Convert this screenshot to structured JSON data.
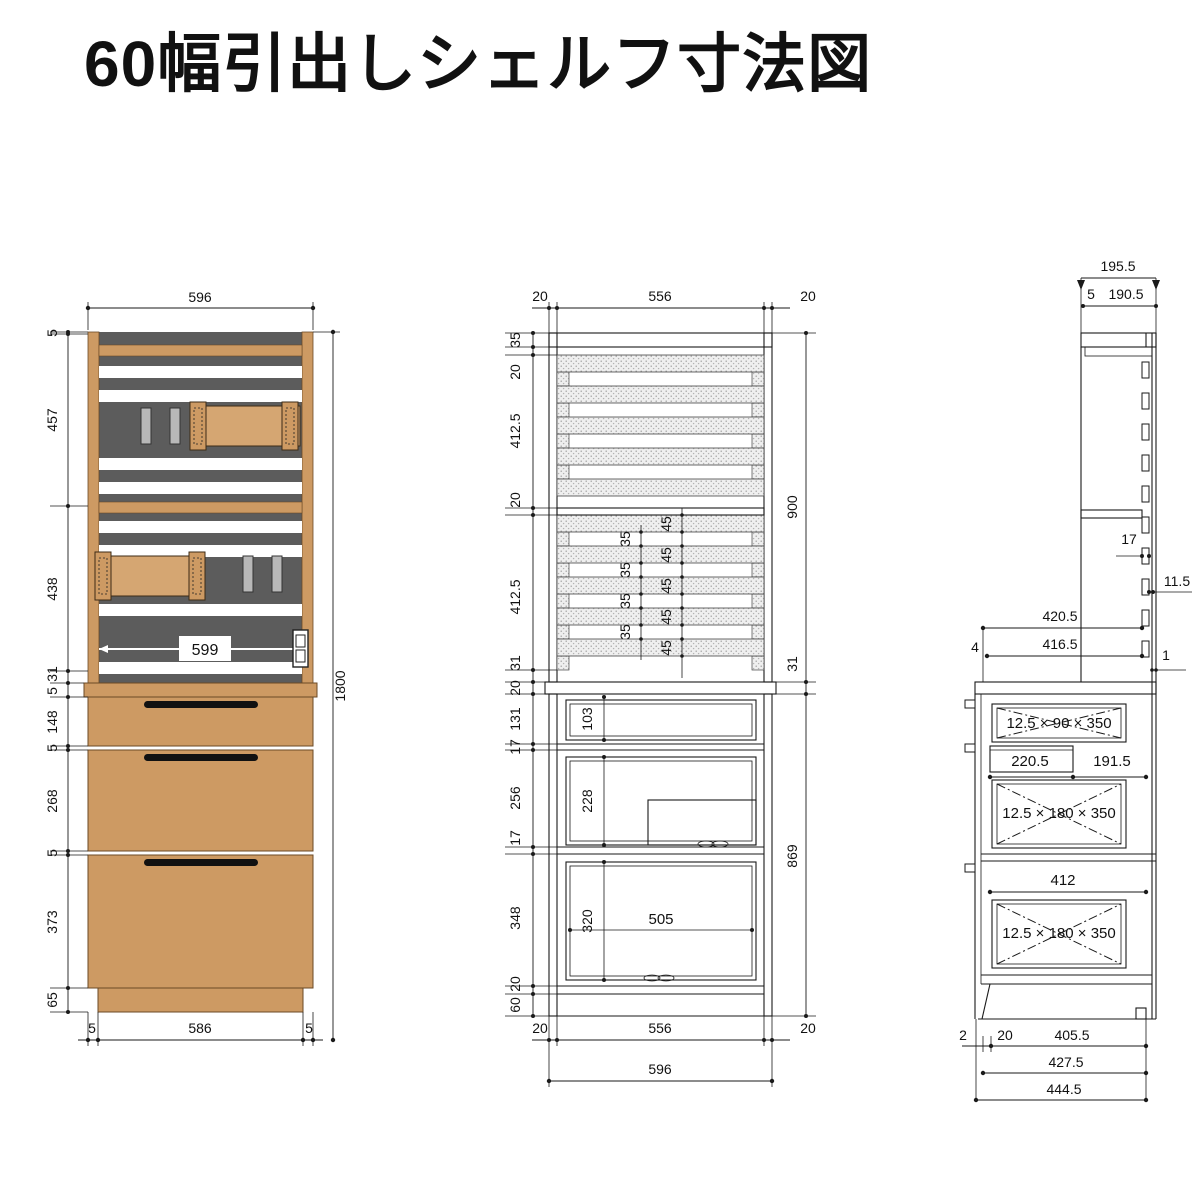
{
  "title": "60幅引出しシェルフ寸法図",
  "colors": {
    "wood": "#cd9a63",
    "wood_border": "#6b4a26",
    "slat_panel": "#5c5c5c",
    "hook_gray": "#b8b8b8",
    "handle_black": "#111111",
    "line": "#1a1a1a"
  },
  "left_view": {
    "top_width": "596",
    "left_chain": [
      "5",
      "457",
      "438",
      "31",
      "5",
      "148",
      "5",
      "268",
      "5",
      "373",
      "65"
    ],
    "inner_width": "599",
    "total_height": "1800",
    "bottom_chain": [
      "5",
      "586",
      "5"
    ]
  },
  "front_view": {
    "top_chain": [
      "20",
      "556",
      "20"
    ],
    "left_chain": [
      "35",
      "20",
      "412.5",
      "20",
      "412.5",
      "31",
      "20",
      "131",
      "17",
      "256",
      "17",
      "348",
      "20",
      "60"
    ],
    "right_chain": [
      "900",
      "31",
      "869"
    ],
    "gap_dims": [
      "35",
      "35",
      "35",
      "35"
    ],
    "slat_dims": [
      "45",
      "45",
      "45",
      "45",
      "45"
    ],
    "drawer1_depth": "103",
    "drawer2_depth": "228",
    "drawer3_depth": "320",
    "drawer3_width": "505",
    "bottom_chain": [
      "20",
      "556",
      "20"
    ],
    "total_width": "596"
  },
  "side_view": {
    "top_total": "195.5",
    "top_offset": "5",
    "top_inner": "190.5",
    "slat_thickness": "17",
    "back_gap": "11.5",
    "upper_depth": "420.5",
    "front_lip": "4",
    "upper_depth_inner": "416.5",
    "back_clearance": "1",
    "drawer1_board": "12.5 × 90 × 350",
    "rail_depth": "220.5",
    "rail_rest": "191.5",
    "drawer2_board": "12.5 × 180 × 350",
    "drawer3_top_width": "412",
    "drawer3_board": "12.5 × 180 × 350",
    "bottom_chain": [
      "2",
      "20",
      "405.5"
    ],
    "bottom_mid": "427.5",
    "bottom_total": "444.5"
  }
}
